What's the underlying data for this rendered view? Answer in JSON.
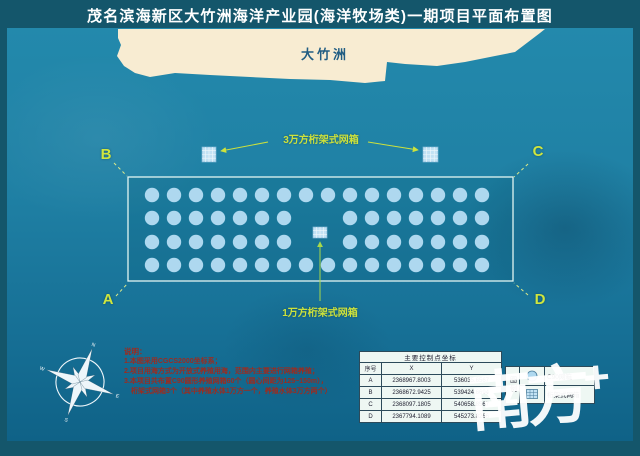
{
  "title": "茂名滨海新区大竹洲海洋产业园(海洋牧场类)一期项目平面布置图",
  "island": {
    "label": "大竹洲"
  },
  "corners": {
    "top_left": "B",
    "top_right": "C",
    "bottom_left": "A",
    "bottom_right": "D"
  },
  "labels": {
    "truss_30k": "3万方桁架式网箱",
    "truss_10k": "1万方桁架式网箱"
  },
  "notes": {
    "heading": "说明：",
    "lines": [
      "1.本图采用CGCS2000坐标系；",
      "2.项目用海方式为开放式养殖用海，范围内主要进行网箱养殖；",
      "3.本项目共布置C90圆形养殖网箱60个（圆心间距为125~150m），",
      "　桁架式网箱3个（其中养殖水体1万方一个，养殖水体3万方两个）"
    ]
  },
  "table": {
    "title": "主要控制点坐标",
    "headers": [
      "序号",
      "X",
      "Y"
    ],
    "rows": [
      [
        "A",
        "2368967.8003",
        "536035.6567"
      ],
      [
        "B",
        "2368672.9425",
        "539424.6694"
      ],
      [
        "C",
        "2368097.1805",
        "540658.8567"
      ],
      [
        "D",
        "2367794.1089",
        "545273.8266"
      ]
    ]
  },
  "legend": {
    "title": "图例",
    "items": [
      {
        "icon": "circle-cage-icon",
        "label": "C90网箱"
      },
      {
        "icon": "truss-cage-icon",
        "label": "桁架式网箱"
      }
    ]
  },
  "watermark": {
    "name": "南方",
    "plus": "+"
  },
  "cage_grid": {
    "origin_x": 152,
    "spacing": 22,
    "radius": 7.2,
    "rows": [
      {
        "y": 195,
        "cols": "0-15"
      },
      {
        "y": 218,
        "cols": "0-6,9-15"
      },
      {
        "y": 242,
        "cols": "0-6,9-15"
      },
      {
        "y": 265,
        "cols": "0-15"
      }
    ],
    "total_circular_cages": 60
  },
  "colors": {
    "frame": "#14566b",
    "ocean": "#1f80a4",
    "island": "#f8ecd2",
    "island_text": "#215d83",
    "annotation_green": "#cde23c",
    "note_red": "#9e2b1e",
    "cage_fill": "#aed8ef",
    "boundary_stroke": "#e2f6f2"
  }
}
